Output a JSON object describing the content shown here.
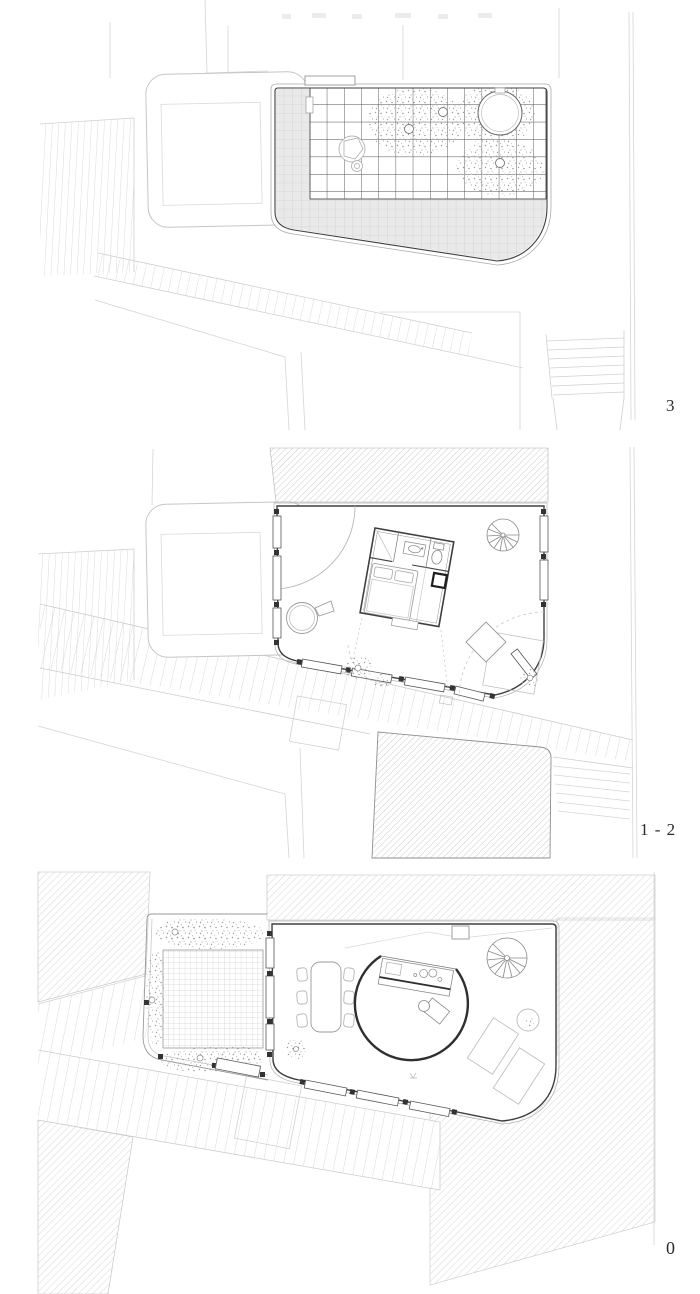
{
  "document": {
    "type": "architectural floor plan sheet",
    "plan_count": 3
  },
  "plans": [
    {
      "label": "3",
      "name": "roof-plan",
      "features": [
        "neighbor-building",
        "roof-pergola-grid",
        "roof-terrace-paving",
        "stair-skylight-opening",
        "tree-canopies",
        "tree-trunks",
        "street-paving",
        "outdoor-stairs"
      ]
    },
    {
      "label": "1 - 2",
      "name": "levels-1-2-plan",
      "features": [
        "bedroom-box",
        "bed",
        "bathroom-sink",
        "toilet",
        "fireplace-box",
        "spiral-stair",
        "curved-partition",
        "round-bathtub",
        "rug",
        "ottoman",
        "plants",
        "window-wall",
        "neighbor-buildings",
        "street-paving"
      ]
    },
    {
      "label": "0",
      "name": "ground-floor-plan",
      "features": [
        "garden-courtyard",
        "trellis-grid",
        "garden-vegetation",
        "dining-table",
        "chairs",
        "curved-kitchen-island",
        "kitchen-counter",
        "spiral-stair",
        "loungers",
        "side-table",
        "plants",
        "window-wall",
        "entry-gate",
        "neighbor-buildings",
        "street-paving"
      ]
    }
  ],
  "colors": {
    "paper": "#ffffff",
    "wall_dark": "#3f3f3f",
    "kitchen_wall": "#2f2f2f",
    "line_mid": "#8a8a8a",
    "line_light": "#c9c9c9",
    "hatch": "#bcbcbc",
    "paving_fill": "#e9e9e9",
    "pergola_grid": "#4d4d4d",
    "label_color": "#2b2b2b"
  }
}
